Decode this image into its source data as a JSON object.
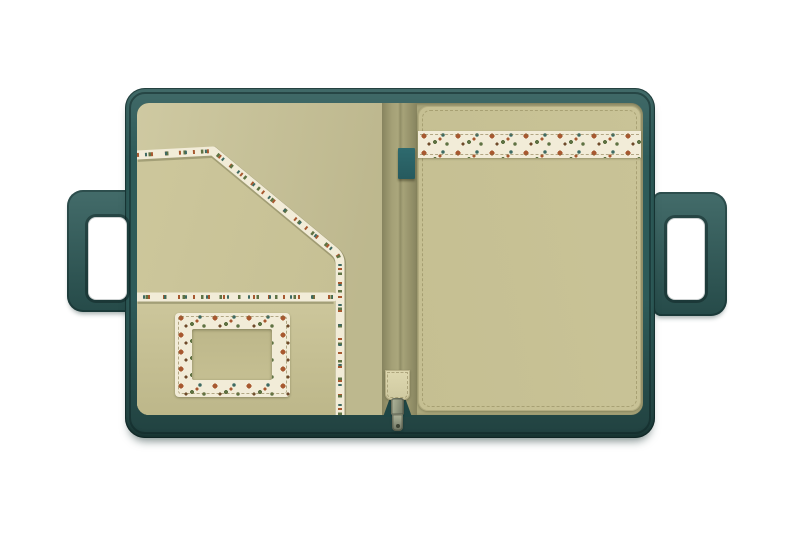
{
  "scene": {
    "description": "Product photo of an open teal zip-around portfolio organizer with cut-out carry handles, olive interior pockets, botanical floral-print trim, and a metal zipper pull at the bottom center",
    "background": "#ffffff"
  },
  "colors": {
    "page_bg": "#ffffff",
    "shell_teal": "#2e5b59",
    "shell_teal_dark": "#1f4645",
    "lining_olive": "#c9c397",
    "lining_olive_light": "#cdc79c",
    "pocket_olive": "#c5bf92",
    "pocket_shade": "#bdb78a",
    "spine_olive": "#aba77c",
    "floral_cream": "#f2ecd8",
    "floral_rust": "#a7582f",
    "floral_green": "#5f7243",
    "floral_teal": "#3e6a62",
    "floral_brown": "#6f4a2a",
    "tab_teal": "#2e6a6e",
    "strap_cream": "#ded8b0",
    "zip_metal": "#9ba188",
    "zip_metal_dark": "#6d7362"
  },
  "product": {
    "shell": "teal leather zip-around folio shell",
    "left_handle": "teal carry handle with rectangular cut-out grip",
    "right_handle": "teal carry handle with rectangular cut-out grip",
    "left_panel": {
      "diagonal_pocket": "envelope-style slip pocket with diagonal floral-trimmed edge",
      "lower_pocket": "patch pocket with floral-trimmed top edge",
      "card_window": "ID card pocket with floral-print frame and clear window"
    },
    "spine": {
      "pen_tab": "teal elastic tab on center gusset"
    },
    "right_panel": {
      "main_pocket": "full-height slip pocket",
      "floral_band": "horizontal botanical floral-print trim band"
    },
    "zipper": {
      "strap": "cream interior zip base strap",
      "slider": "metal zipper slider",
      "pull": "metal dangling zipper pull tab"
    }
  }
}
